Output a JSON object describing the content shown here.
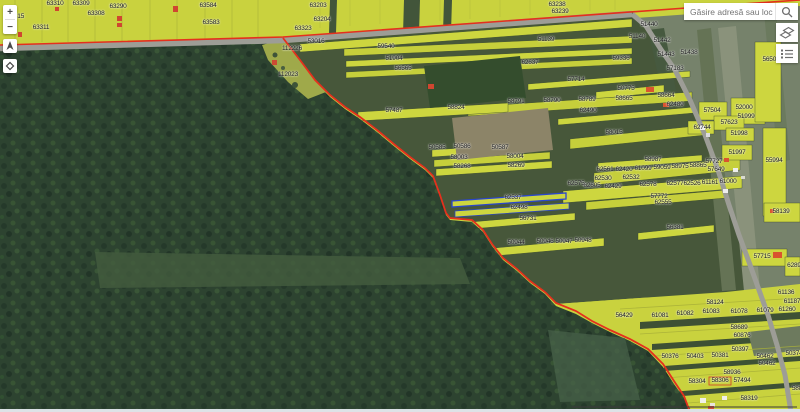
{
  "search": {
    "placeholder": "Găsire adresă sau loc",
    "icon": "search-icon"
  },
  "toolbar": {
    "buttons": [
      {
        "name": "basemap-gallery",
        "icon": "basemap-icon"
      },
      {
        "name": "layer-list",
        "icon": "layer-list-icon"
      }
    ]
  },
  "nav": {
    "zoom_in": "+",
    "zoom_out": "−",
    "compass_icon": "north-arrow-icon",
    "locate_icon": "diamond-icon"
  },
  "map": {
    "selected_parcel": "62537",
    "colors": {
      "parcel_fill": "#ccd63e",
      "boundary_red": "#e5301d",
      "selected_blue": "#2b46cc",
      "forest": "#2d4330",
      "natural_field": "#76826b",
      "road": "#9d9d96"
    },
    "labels": [
      [
        "63310",
        55,
        4
      ],
      [
        "63309",
        81,
        4
      ],
      [
        "63290",
        118,
        7
      ],
      [
        "63308",
        96,
        14
      ],
      [
        "315",
        19,
        17
      ],
      [
        "63311",
        41,
        28
      ],
      [
        "63584",
        208,
        6
      ],
      [
        "63583",
        211,
        23
      ],
      [
        "63203",
        318,
        6
      ],
      [
        "63204",
        322,
        20
      ],
      [
        "63323",
        303,
        29
      ],
      [
        "53016",
        316,
        42
      ],
      [
        "63238",
        557,
        5
      ],
      [
        "63239",
        560,
        12
      ],
      [
        "112226",
        292,
        49
      ],
      [
        "112023",
        288,
        75
      ],
      [
        "59540",
        386,
        47
      ],
      [
        "51904",
        394,
        59
      ],
      [
        "56565",
        403,
        69
      ],
      [
        "51139",
        546,
        40
      ],
      [
        "62637",
        530,
        63
      ],
      [
        "57714",
        576,
        80
      ],
      [
        "51440",
        649,
        25
      ],
      [
        "51140",
        637,
        37
      ],
      [
        "51442",
        662,
        41
      ],
      [
        "51443",
        666,
        55
      ],
      [
        "51438",
        689,
        53
      ],
      [
        "59336",
        621,
        59
      ],
      [
        "57183",
        675,
        69
      ],
      [
        "56509",
        771,
        60
      ],
      [
        "50775",
        626,
        89
      ],
      [
        "58791",
        516,
        102
      ],
      [
        "58790",
        552,
        101
      ],
      [
        "58789",
        587,
        100
      ],
      [
        "58665",
        624,
        99
      ],
      [
        "58664",
        666,
        96
      ],
      [
        "62490",
        588,
        111
      ],
      [
        "62489",
        675,
        105
      ],
      [
        "57487",
        394,
        111
      ],
      [
        "58824",
        456,
        108
      ],
      [
        "58015",
        614,
        133
      ],
      [
        "57504",
        712,
        111
      ],
      [
        "52000",
        744,
        108
      ],
      [
        "51999",
        746,
        117
      ],
      [
        "57623",
        729,
        123
      ],
      [
        "62744",
        702,
        128
      ],
      [
        "51998",
        739,
        134
      ],
      [
        "51997",
        737,
        153
      ],
      [
        "55994",
        774,
        161
      ],
      [
        "50585",
        437,
        148
      ],
      [
        "50586",
        462,
        147
      ],
      [
        "50587",
        500,
        148
      ],
      [
        "58003",
        459,
        158
      ],
      [
        "58004",
        515,
        157
      ],
      [
        "58268",
        462,
        167
      ],
      [
        "58269",
        516,
        166
      ],
      [
        "58987",
        653,
        160
      ],
      [
        "62561",
        605,
        170
      ],
      [
        "62420",
        624,
        170
      ],
      [
        "61099",
        643,
        169
      ],
      [
        "59059",
        662,
        168
      ],
      [
        "58975",
        680,
        167
      ],
      [
        "58865",
        698,
        166
      ],
      [
        "57727",
        714,
        162
      ],
      [
        "57649",
        716,
        170
      ],
      [
        "62530",
        603,
        179
      ],
      [
        "62532",
        631,
        178
      ],
      [
        "62605",
        592,
        186
      ],
      [
        "62429",
        613,
        187
      ],
      [
        "62578",
        648,
        185
      ],
      [
        "62577",
        675,
        184
      ],
      [
        "62526",
        692,
        184
      ],
      [
        "61161",
        710,
        183
      ],
      [
        "61000",
        728,
        182
      ],
      [
        "62575",
        576,
        184
      ],
      [
        "62537",
        513,
        198
      ],
      [
        "62498",
        519,
        208
      ],
      [
        "56731",
        528,
        219
      ],
      [
        "57772",
        659,
        197
      ],
      [
        "62555",
        663,
        203
      ],
      [
        "58139",
        781,
        212
      ],
      [
        "56381",
        675,
        228
      ],
      [
        "50944",
        516,
        243
      ],
      [
        "50946",
        545,
        242
      ],
      [
        "50947",
        564,
        242
      ],
      [
        "50948",
        583,
        241
      ],
      [
        "57715",
        762,
        257
      ],
      [
        "6289",
        794,
        266
      ],
      [
        "61136",
        786,
        293
      ],
      [
        "58124",
        715,
        303
      ],
      [
        "61187",
        792,
        302
      ],
      [
        "56429",
        624,
        316
      ],
      [
        "61081",
        660,
        316
      ],
      [
        "61082",
        685,
        314
      ],
      [
        "61083",
        711,
        312
      ],
      [
        "61078",
        739,
        312
      ],
      [
        "61079",
        765,
        311
      ],
      [
        "61260",
        787,
        310
      ],
      [
        "58689",
        739,
        328
      ],
      [
        "60876",
        742,
        336
      ],
      [
        "50397",
        740,
        350
      ],
      [
        "50376",
        670,
        357
      ],
      [
        "50403",
        695,
        357
      ],
      [
        "50381",
        720,
        356
      ],
      [
        "50462",
        765,
        357
      ],
      [
        "50374",
        794,
        354
      ],
      [
        "50462",
        767,
        364
      ],
      [
        "58936",
        732,
        373
      ],
      [
        "58304",
        697,
        382
      ],
      [
        "58306",
        720,
        381
      ],
      [
        "57494",
        742,
        381
      ],
      [
        "58319",
        749,
        399
      ],
      [
        "588",
        797,
        389
      ]
    ]
  }
}
